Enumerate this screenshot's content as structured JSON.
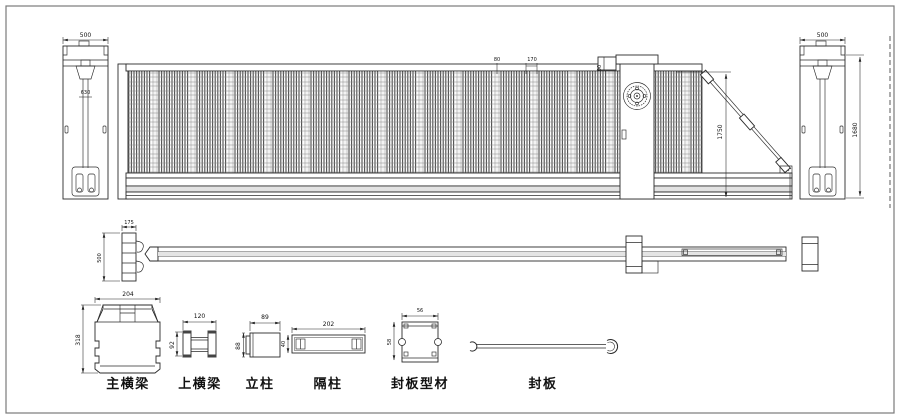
{
  "colors": {
    "line": "#2b2b2b",
    "background": "#ffffff"
  },
  "elevation": {
    "left_column": {
      "width": "500",
      "inner": "630"
    },
    "panel": {
      "dim_a": "80",
      "dim_b": "170"
    },
    "motor": {
      "dim": "90"
    },
    "brace": {
      "height": "1750"
    },
    "right_column": {
      "width": "500",
      "height": "1680"
    }
  },
  "plan": {
    "width": "175",
    "depth": "500"
  },
  "components": {
    "main_beam": {
      "label": "主横梁",
      "width": "204",
      "height": "318"
    },
    "top_beam": {
      "label": "上横梁",
      "width": "120",
      "height": "92"
    },
    "post": {
      "label": "立柱",
      "width": "89",
      "height": "88"
    },
    "spacer": {
      "label": "隔柱",
      "width": "202",
      "height": "40"
    },
    "seal_profile": {
      "label": "封板型材",
      "width": "56",
      "height": "58"
    },
    "seal_plate": {
      "label": "封板"
    }
  }
}
